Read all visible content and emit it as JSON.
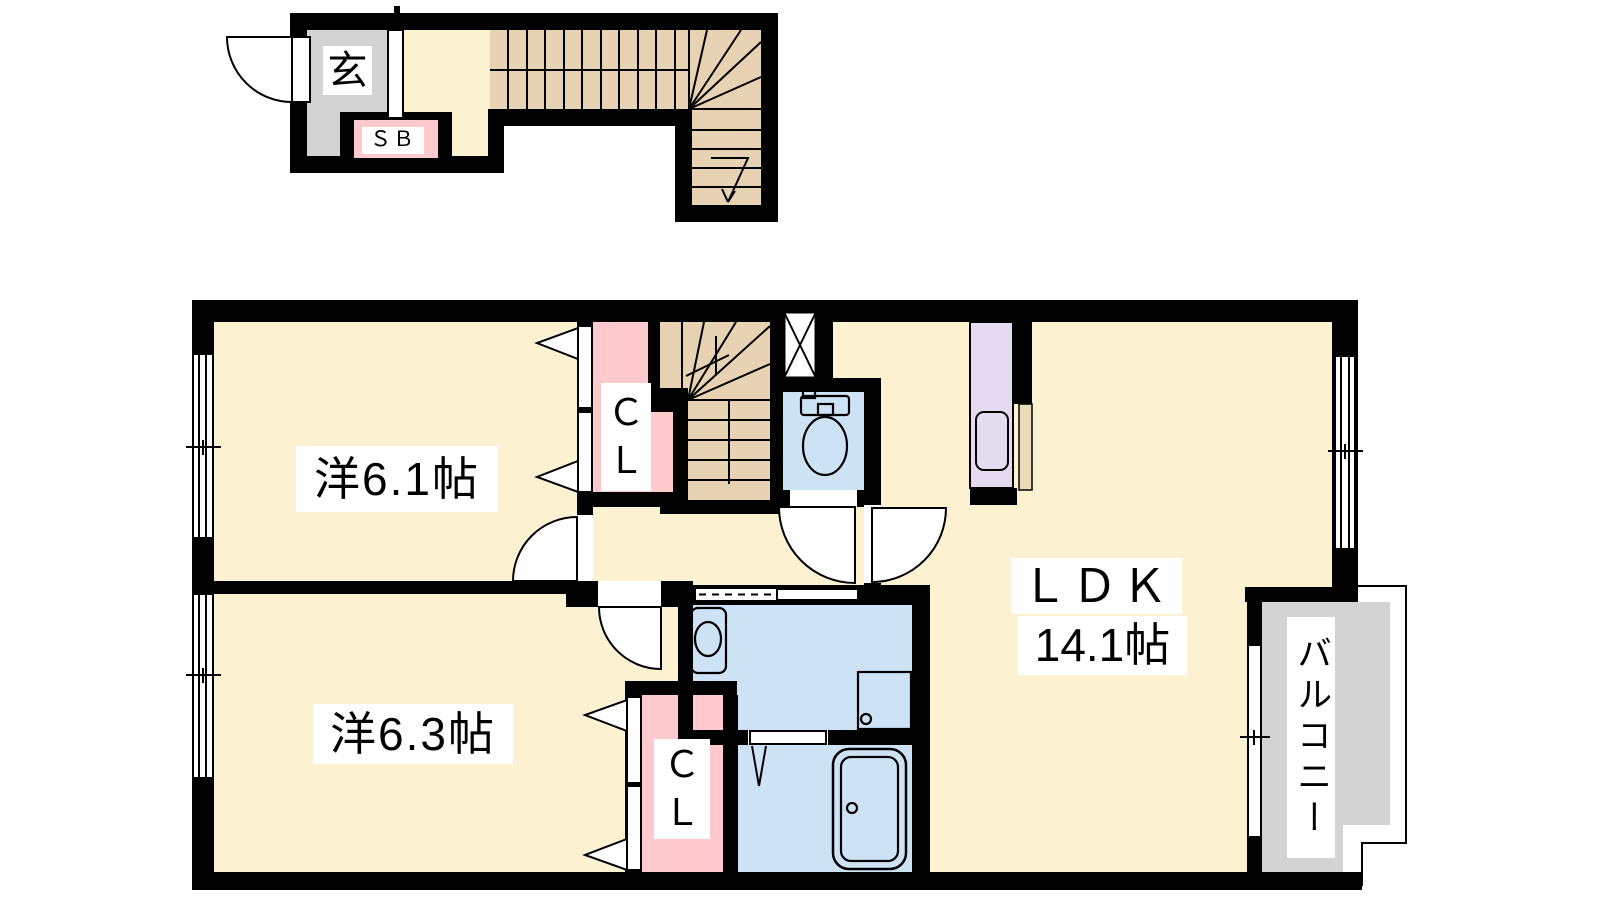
{
  "colors": {
    "wall": "#000000",
    "floor": "#FCF2D2",
    "stairs": "#E7D3B4",
    "closet": "#FFC9CD",
    "wet": "#CEE2F6",
    "kitchen": "#E4DBF1",
    "counter": "#E7DBBA",
    "outdoor": "#D3D3D3",
    "label_bg": "#FFFFFF"
  },
  "first_floor": {
    "entrance_label": "玄",
    "shoe_box_label": "ＳＢ"
  },
  "second_floor": {
    "room_61_label": "洋6.1帖",
    "room_63_label": "洋6.3帖",
    "ldk_label": "ＬＤＫ",
    "ldk_size_label": "14.1帖",
    "closet_upper_label": "ＣＬ",
    "closet_lower_label": "ＣＬ",
    "balcony_label": "バルコニー"
  }
}
